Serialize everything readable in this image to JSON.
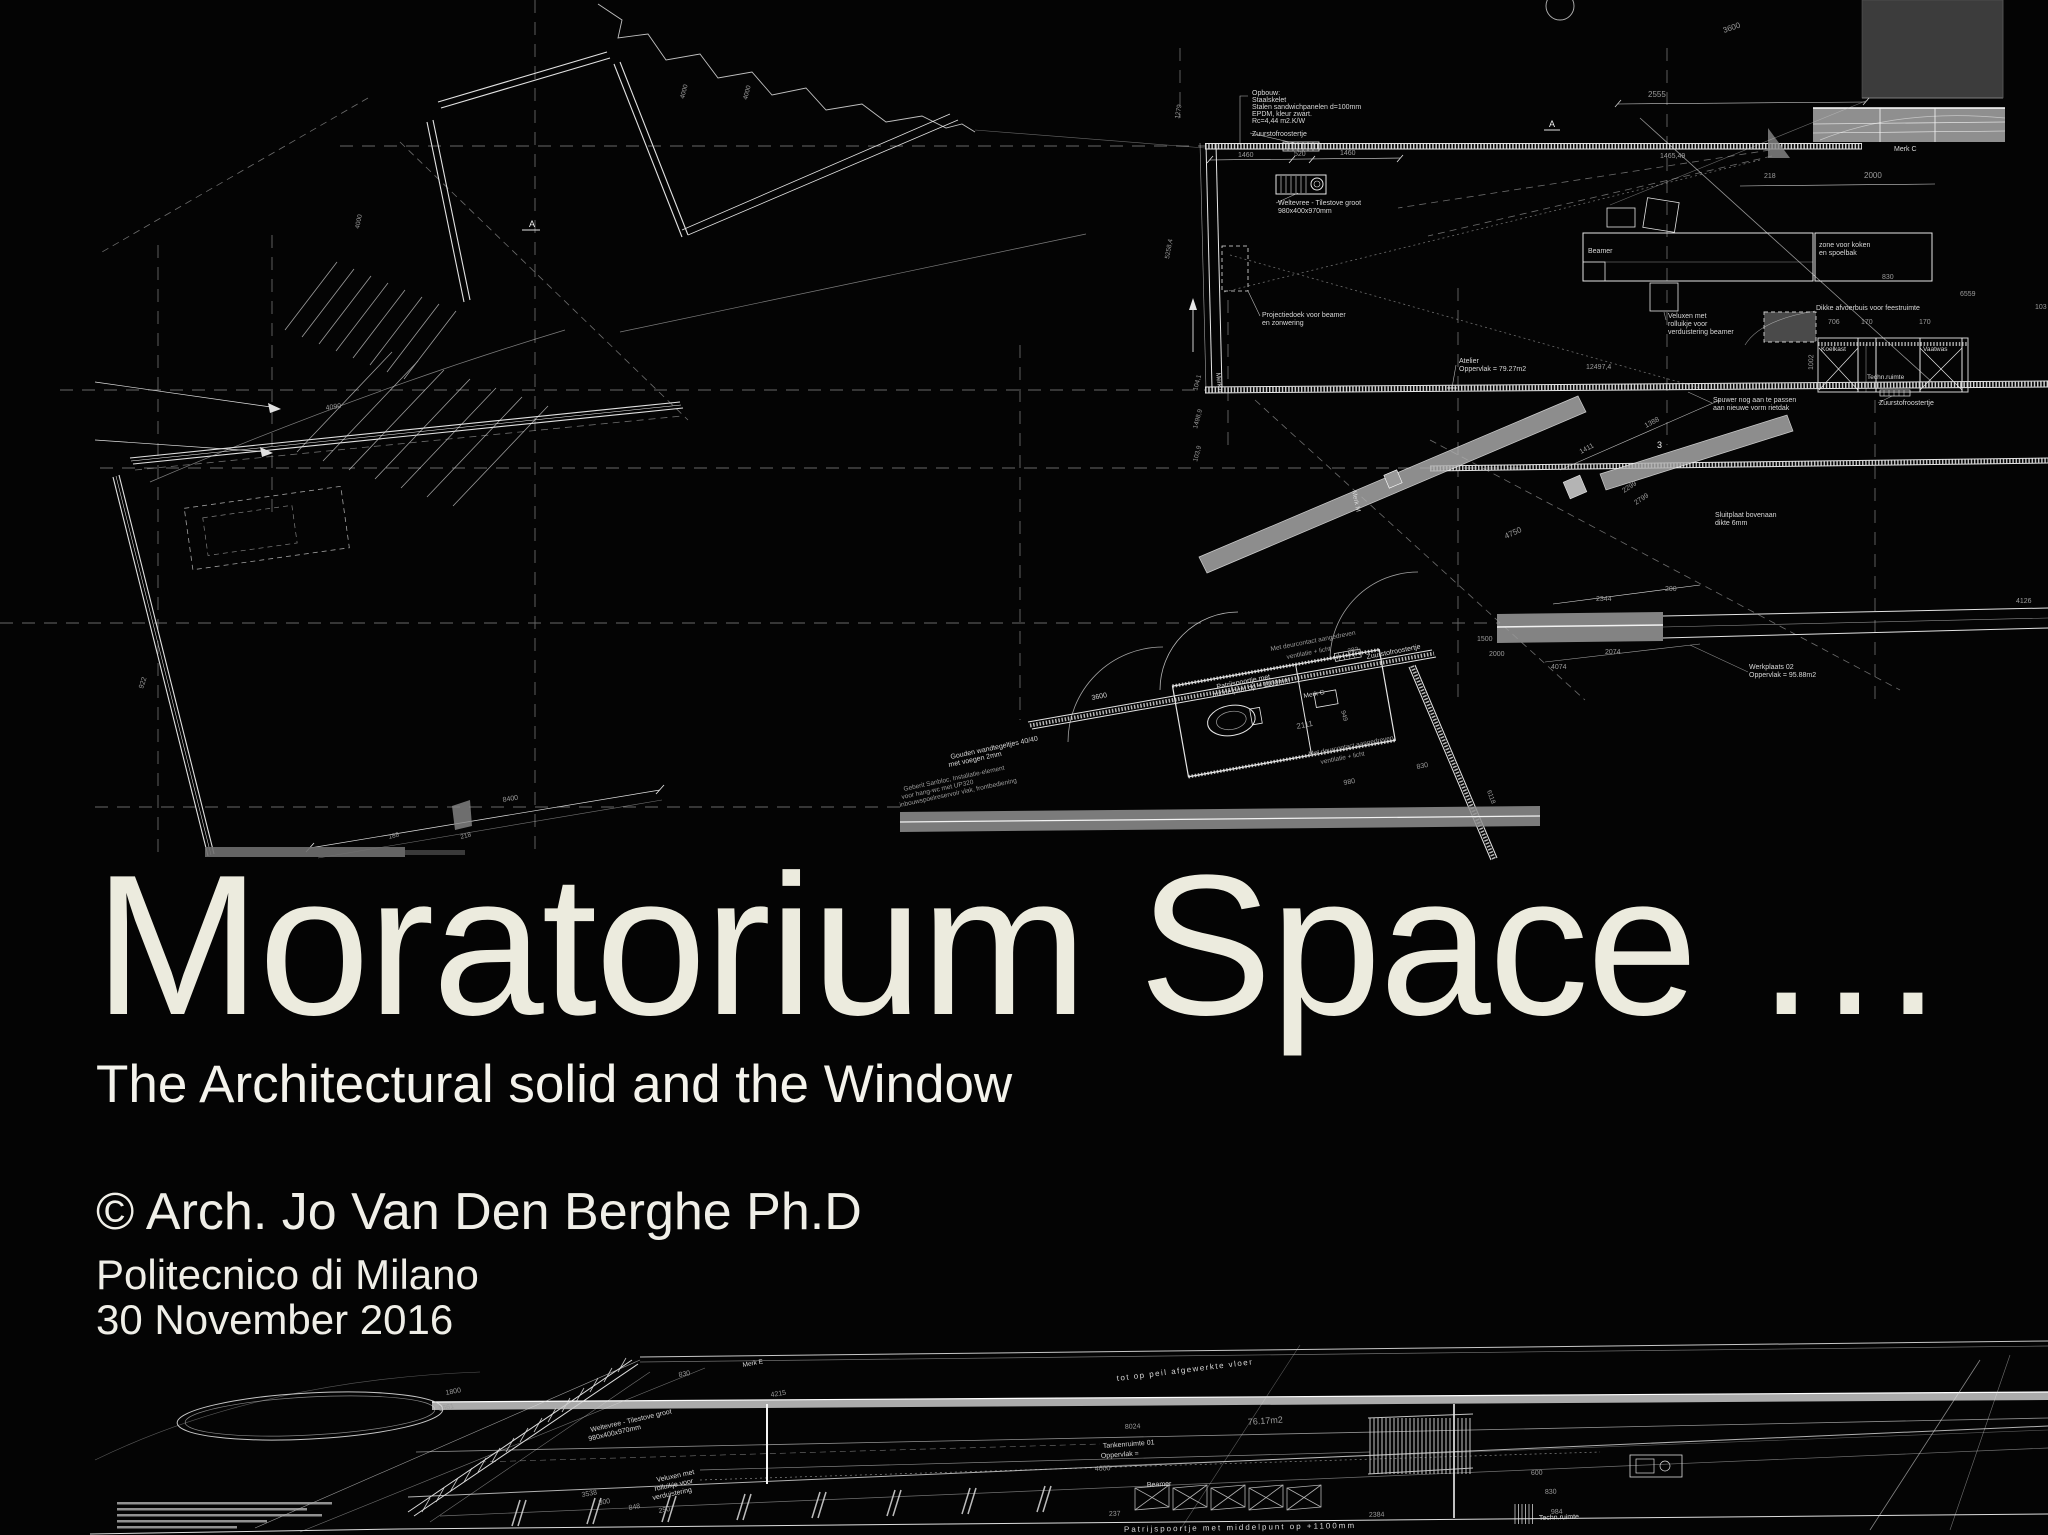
{
  "slide": {
    "title": "Moratorium Space …",
    "subtitle": "The Architectural solid and the Window",
    "credit": "© Arch. Jo Van Den Berghe Ph.D",
    "institution": "Politecnico di Milano",
    "date": "30 November 2016"
  },
  "colors": {
    "background": "#040404",
    "title_text": "#ecebde",
    "subtitle_text": "#f4f3ec",
    "credit_text": "#f0efe8",
    "meta_text": "#efeee7",
    "line": "#dcdcdc",
    "gray_block": "#3c3c3c",
    "highlight_bar": "#a8a8a8",
    "beam_gray": "#b0b0b0"
  },
  "drawing": {
    "description": "black-background architectural floor plan (white line work) above title, with sheared perspective plan at bottom",
    "label_colors": {
      "txt": "#d8d8d8",
      "dim": "#9c9c9c",
      "bright": "#f3f3f3"
    },
    "annotations": [
      {
        "t": "Opbouw:",
        "x": 1252,
        "y": 95
      },
      {
        "t": "Staalskelet",
        "x": 1252,
        "y": 102
      },
      {
        "t": "Stalen sandwichpanelen d=100mm",
        "x": 1252,
        "y": 109
      },
      {
        "t": "EPDM, kleur zwart.",
        "x": 1252,
        "y": 116
      },
      {
        "t": "Rc=4,44 m2.K/W",
        "x": 1252,
        "y": 123
      },
      {
        "t": "Zuurstofroostertje",
        "x": 1252,
        "y": 136
      },
      {
        "t": "1460",
        "x": 1238,
        "y": 157,
        "c": "dim"
      },
      {
        "t": "520",
        "x": 1294,
        "y": 156,
        "c": "dim"
      },
      {
        "t": "1460",
        "x": 1340,
        "y": 155,
        "c": "dim"
      },
      {
        "t": "Weltevree - Tilestove groot",
        "x": 1278,
        "y": 205
      },
      {
        "t": "980x400x970mm",
        "x": 1278,
        "y": 213
      },
      {
        "t": "Projectiedoek voor beamer",
        "x": 1262,
        "y": 317
      },
      {
        "t": "en zonwering",
        "x": 1262,
        "y": 325
      },
      {
        "t": "Atelier",
        "x": 1459,
        "y": 363
      },
      {
        "t": "Oppervlak = 79.27m2",
        "x": 1459,
        "y": 371
      },
      {
        "t": "12497,4",
        "x": 1586,
        "y": 369,
        "c": "dim"
      },
      {
        "t": "2555",
        "x": 1648,
        "y": 97,
        "c": "dim",
        "s": 8
      },
      {
        "t": "3600",
        "x": 1724,
        "y": 33,
        "r": -19,
        "c": "dim",
        "s": 8
      },
      {
        "t": "1465,49",
        "x": 1660,
        "y": 158,
        "c": "dim"
      },
      {
        "t": "218",
        "x": 1764,
        "y": 178,
        "c": "dim"
      },
      {
        "t": "2000",
        "x": 1864,
        "y": 178,
        "c": "dim",
        "s": 8
      },
      {
        "t": "Merk C",
        "x": 1894,
        "y": 151
      },
      {
        "t": "Beamer",
        "x": 1588,
        "y": 253
      },
      {
        "t": "zone voor koken",
        "x": 1819,
        "y": 247
      },
      {
        "t": "en spoelbak",
        "x": 1819,
        "y": 255
      },
      {
        "t": "830",
        "x": 1882,
        "y": 279,
        "c": "dim"
      },
      {
        "t": "Veluxen met",
        "x": 1668,
        "y": 318
      },
      {
        "t": "rolluikje voor",
        "x": 1668,
        "y": 326
      },
      {
        "t": "verduistering beamer",
        "x": 1668,
        "y": 334
      },
      {
        "t": "Dikke afvoerbuis voor feestruimte",
        "x": 1816,
        "y": 310
      },
      {
        "t": "706",
        "x": 1828,
        "y": 324,
        "c": "dim"
      },
      {
        "t": "170",
        "x": 1861,
        "y": 324,
        "c": "dim"
      },
      {
        "t": "170",
        "x": 1919,
        "y": 324,
        "c": "dim"
      },
      {
        "t": "1002",
        "x": 1813,
        "y": 370,
        "r": -89,
        "c": "dim"
      },
      {
        "t": "Koelkast",
        "x": 1821,
        "y": 351,
        "s": 6.5
      },
      {
        "t": "Vaatwas",
        "x": 1923,
        "y": 351,
        "s": 6.5
      },
      {
        "t": "Techn.ruimte",
        "x": 1867,
        "y": 379,
        "s": 6.5
      },
      {
        "t": "Zuurstofroostertje",
        "x": 1879,
        "y": 405
      },
      {
        "t": "Spuwer nog aan te passen",
        "x": 1713,
        "y": 402
      },
      {
        "t": "aan nieuwe vorm rietdak",
        "x": 1713,
        "y": 410
      },
      {
        "t": "6559",
        "x": 1960,
        "y": 296,
        "c": "dim"
      },
      {
        "t": "103",
        "x": 2035,
        "y": 309,
        "c": "dim"
      },
      {
        "t": "Sluitplaat bovenaan",
        "x": 1715,
        "y": 517
      },
      {
        "t": "dikte 6mm",
        "x": 1715,
        "y": 525
      },
      {
        "t": "Werkplaats 02",
        "x": 1749,
        "y": 669
      },
      {
        "t": "Oppervlak =  95.88m2",
        "x": 1749,
        "y": 677
      },
      {
        "t": "2344",
        "x": 1596,
        "y": 601,
        "c": "dim"
      },
      {
        "t": "200",
        "x": 1665,
        "y": 591,
        "c": "dim"
      },
      {
        "t": "2074",
        "x": 1605,
        "y": 654,
        "c": "dim"
      },
      {
        "t": "4074",
        "x": 1551,
        "y": 669,
        "c": "dim"
      },
      {
        "t": "4126",
        "x": 2016,
        "y": 603,
        "c": "dim"
      },
      {
        "t": "1388",
        "x": 1646,
        "y": 428,
        "r": -28,
        "c": "dim"
      },
      {
        "t": "1411",
        "x": 1581,
        "y": 454,
        "r": -28,
        "c": "dim"
      },
      {
        "t": "3",
        "x": 1657,
        "y": 448,
        "s": 9,
        "c": "bright"
      },
      {
        "t": "2299",
        "x": 1624,
        "y": 493,
        "r": -33,
        "c": "dim"
      },
      {
        "t": "2799",
        "x": 1636,
        "y": 505,
        "r": -33,
        "c": "dim"
      },
      {
        "t": "4750",
        "x": 1506,
        "y": 539,
        "r": -25,
        "c": "dim",
        "s": 8
      },
      {
        "t": "104,1",
        "x": 1197,
        "y": 391,
        "r": -75,
        "c": "dim",
        "s": 6.5
      },
      {
        "t": "1498,9",
        "x": 1197,
        "y": 429,
        "r": -75,
        "c": "dim",
        "s": 6.5
      },
      {
        "t": "103,9",
        "x": 1197,
        "y": 462,
        "r": -75,
        "c": "dim",
        "s": 6.5
      },
      {
        "t": "Merk M",
        "x": 1352,
        "y": 491,
        "r": 78,
        "s": 6.5
      },
      {
        "t": "Merk N",
        "x": 1216,
        "y": 373,
        "r": 83,
        "s": 6.5
      },
      {
        "t": "1279",
        "x": 1179,
        "y": 119,
        "r": -80,
        "c": "dim",
        "s": 6.5
      },
      {
        "t": "5258,4",
        "x": 1169,
        "y": 259,
        "r": -80,
        "c": "dim",
        "s": 6.5
      },
      {
        "t": "3600",
        "x": 1092,
        "y": 700,
        "r": -11
      },
      {
        "t": "8400",
        "x": 503,
        "y": 802,
        "r": -9,
        "c": "dim"
      },
      {
        "t": "4090",
        "x": 326,
        "y": 410,
        "r": -8,
        "c": "dim"
      },
      {
        "t": "922",
        "x": 143,
        "y": 689,
        "r": -72,
        "c": "dim"
      },
      {
        "t": "188",
        "x": 389,
        "y": 839,
        "r": -15,
        "c": "dim",
        "s": 6.5
      },
      {
        "t": "218",
        "x": 461,
        "y": 839,
        "r": -15,
        "c": "dim",
        "s": 6.5
      },
      {
        "t": "Patrijspoortje met",
        "x": 1217,
        "y": 689,
        "r": -11
      },
      {
        "t": "middelpunt op + 1100mm",
        "x": 1213,
        "y": 697,
        "r": -11
      },
      {
        "t": "Met deurcontact aangedreven",
        "x": 1271,
        "y": 651,
        "r": -11,
        "c": "dim",
        "s": 6.5
      },
      {
        "t": "ventilatie + licht",
        "x": 1287,
        "y": 659,
        "r": -11,
        "c": "dim",
        "s": 6.5
      },
      {
        "t": "Zuurstofroostertje",
        "x": 1367,
        "y": 659,
        "r": -11
      },
      {
        "t": "Met deurcontact aangedreven",
        "x": 1309,
        "y": 756,
        "r": -11,
        "c": "dim",
        "s": 6.5
      },
      {
        "t": "ventilatie + licht",
        "x": 1321,
        "y": 764,
        "r": -11,
        "c": "dim",
        "s": 6.5
      },
      {
        "t": "2111",
        "x": 1297,
        "y": 729,
        "r": -11,
        "c": "dim",
        "s": 8
      },
      {
        "t": "949",
        "x": 1341,
        "y": 711,
        "r": 75,
        "c": "dim",
        "s": 6.5
      },
      {
        "t": "980",
        "x": 1344,
        "y": 785,
        "r": -11,
        "c": "dim"
      },
      {
        "t": "830",
        "x": 1417,
        "y": 769,
        "r": -11,
        "c": "dim"
      },
      {
        "t": "382",
        "x": 1348,
        "y": 653,
        "r": -11,
        "c": "dim",
        "s": 6.5
      },
      {
        "t": "1500",
        "x": 1477,
        "y": 641,
        "c": "dim"
      },
      {
        "t": "2000",
        "x": 1489,
        "y": 656,
        "c": "dim"
      },
      {
        "t": "6118",
        "x": 1487,
        "y": 791,
        "r": 70,
        "c": "dim",
        "s": 6.5
      },
      {
        "t": "Gouden wandtegeltjes 40/40",
        "x": 951,
        "y": 759,
        "r": -12
      },
      {
        "t": "met voegen 2mm",
        "x": 949,
        "y": 767,
        "r": -12
      },
      {
        "t": "Geberit Sanbloc, Installatie-element",
        "x": 904,
        "y": 791,
        "r": -12,
        "c": "dim",
        "s": 6.5
      },
      {
        "t": "voor hang-wc met UP320",
        "x": 902,
        "y": 799,
        "r": -12,
        "c": "dim",
        "s": 6.5
      },
      {
        "t": "inbouwspoelreservoir vlak, frontbediening",
        "x": 900,
        "y": 807,
        "r": -12,
        "c": "dim",
        "s": 6.5
      },
      {
        "t": "Merk G",
        "x": 1304,
        "y": 698,
        "r": -11,
        "s": 6.5
      },
      {
        "t": "4000",
        "x": 684,
        "y": 99,
        "r": -75,
        "c": "dim",
        "s": 6.5
      },
      {
        "t": "4000",
        "x": 747,
        "y": 100,
        "r": -75,
        "c": "dim",
        "s": 6.5
      },
      {
        "t": "4000",
        "x": 359,
        "y": 229,
        "r": -78,
        "c": "dim",
        "s": 6.5
      },
      {
        "t": "A",
        "x": 529,
        "y": 227,
        "s": 9,
        "c": "bright"
      },
      {
        "t": "A",
        "x": 1549,
        "y": 127,
        "s": 9,
        "c": "bright"
      },
      {
        "t": "1800",
        "x": 446,
        "y": 1395,
        "r": -11,
        "c": "dim"
      },
      {
        "t": "1661",
        "x": 439,
        "y": 1411,
        "r": -11,
        "c": "dim"
      },
      {
        "t": "830",
        "x": 679,
        "y": 1377,
        "r": -10,
        "c": "dim"
      },
      {
        "t": "4215",
        "x": 771,
        "y": 1397,
        "r": -9,
        "c": "dim"
      },
      {
        "t": "Merk E",
        "x": 743,
        "y": 1367,
        "r": -10,
        "s": 6.5
      },
      {
        "t": "Weltevree - Tilestove groot",
        "x": 591,
        "y": 1432,
        "r": -13
      },
      {
        "t": "980x400x970mm",
        "x": 589,
        "y": 1441,
        "r": -13
      },
      {
        "t": "Veluxen met",
        "x": 657,
        "y": 1482,
        "r": -12
      },
      {
        "t": "rolluikje voor",
        "x": 655,
        "y": 1491,
        "r": -12
      },
      {
        "t": "verduistering",
        "x": 653,
        "y": 1500,
        "r": -12
      },
      {
        "t": "800",
        "x": 599,
        "y": 1505,
        "r": -10,
        "c": "dim"
      },
      {
        "t": "3538",
        "x": 582,
        "y": 1497,
        "r": -10,
        "c": "dim"
      },
      {
        "t": "848",
        "x": 629,
        "y": 1510,
        "r": -10,
        "c": "dim"
      },
      {
        "t": "250",
        "x": 659,
        "y": 1513,
        "r": -10,
        "c": "dim"
      },
      {
        "t": "76.17m2",
        "x": 1248,
        "y": 1425,
        "r": -4,
        "c": "dim",
        "s": 9
      },
      {
        "t": "Tankenruimte 01",
        "x": 1103,
        "y": 1448,
        "r": -4
      },
      {
        "t": "Oppervlak =",
        "x": 1101,
        "y": 1458,
        "r": -4
      },
      {
        "t": "8024",
        "x": 1125,
        "y": 1429,
        "r": -3,
        "c": "dim"
      },
      {
        "t": "4000",
        "x": 1095,
        "y": 1471,
        "r": -3,
        "c": "dim"
      },
      {
        "t": "Beamer",
        "x": 1147,
        "y": 1487,
        "r": -3
      },
      {
        "t": "237",
        "x": 1109,
        "y": 1516,
        "r": -2,
        "c": "dim"
      },
      {
        "t": "2384",
        "x": 1369,
        "y": 1517,
        "r": -2,
        "c": "dim"
      },
      {
        "t": "984",
        "x": 1551,
        "y": 1514,
        "r": -2,
        "c": "dim"
      },
      {
        "t": "830",
        "x": 1545,
        "y": 1494,
        "r": -2,
        "c": "dim"
      },
      {
        "t": "600",
        "x": 1531,
        "y": 1475,
        "r": -2,
        "c": "dim"
      },
      {
        "t": "Techn.ruimte",
        "x": 1539,
        "y": 1520,
        "r": -2,
        "s": 7
      },
      {
        "t": "Patrijspoortje met middelpunt op +1100mm",
        "x": 1124,
        "y": 1532,
        "r": -1,
        "s": 8,
        "ls": 2
      },
      {
        "t": "tot op peil afgewerkte vloer",
        "x": 1117,
        "y": 1381,
        "r": -7,
        "s": 8,
        "ls": 1.5
      }
    ]
  }
}
